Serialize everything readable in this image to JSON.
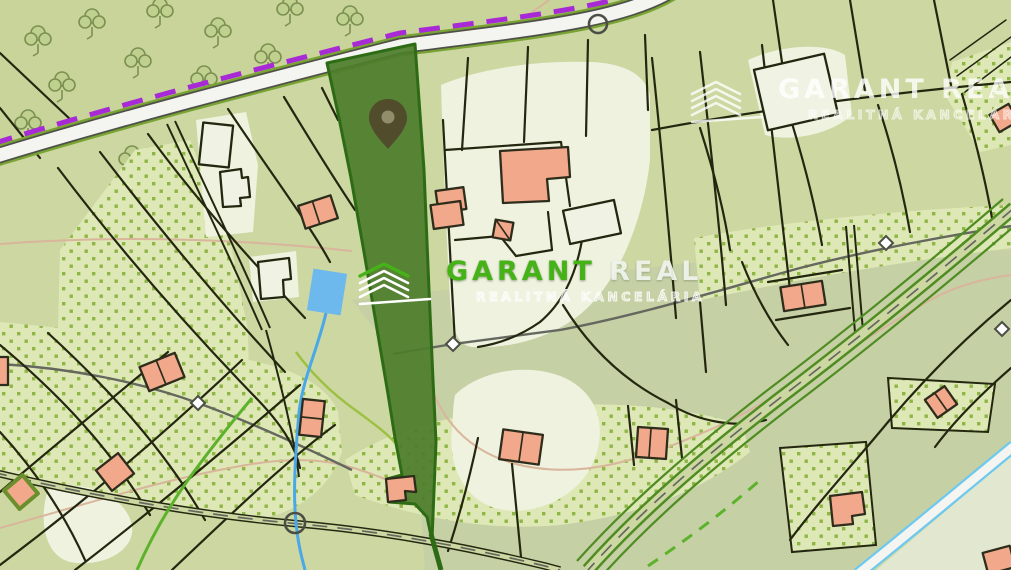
{
  "meta": {
    "view": "cadastral-map",
    "description": "Cadastral map view with a highlighted elongated parcel, location pin and realty watermarks"
  },
  "watermarks": {
    "center": {
      "brand_primary": "GARANT",
      "brand_secondary": "REAL",
      "subtitle": "REALITNÁ KANCELÁRIA"
    },
    "top_right": {
      "brand_primary": "GARANT",
      "brand_secondary": "REAL",
      "subtitle": "REALITNÁ KANCELÁRIA"
    }
  },
  "features": {
    "highlighted_parcel": "selected-parcel",
    "pin": "location-pin",
    "junction_symbol": "circle-junction",
    "waypoint_symbol": "diamond-waypoint",
    "protected_boundary": "purple-dashed-boundary",
    "orchard_fill": "green-dotted-orchard",
    "forest": "deciduous-forest-with-tree-symbols"
  },
  "colors": {
    "base_green": "#ccd7a2",
    "south_tint": "#c6d0a5",
    "forest_green": "#c8d499",
    "pale_plot": "#eef2df",
    "white_plot": "#f0f3e4",
    "corner_pale": "#e2e8d0",
    "dots_bg": "#dee8b6",
    "dot_green": "#8fb544",
    "line_dark": "#23270f",
    "building_salmon": "#f2a88b",
    "building_outline": "#2e2d1c",
    "green_border_building": "#6b8f2c",
    "road_white": "#f4f4f0",
    "road_casing": "#4e5148",
    "road_edge_green": "#79a433",
    "diag_road_green": "#4f8c22",
    "road_cyan": "#6ec9ef",
    "boundary_purple": "#a829d6",
    "path_gray": "#64685f",
    "contour_tan": "#d9b59b",
    "stream_blue": "#4aa8e8",
    "pond_blue": "#6db8ec",
    "bright_path_green": "#5cb32b",
    "yellow_green": "#9cc040",
    "highlight_fill": "#4e7d2b",
    "highlight_border": "#2e6b15",
    "pin_dark": "#504c2c",
    "pin_hole": "#908e6a",
    "brand_green": "#45b318",
    "brand_white": "#eef3ea",
    "symbol_stroke": "#4b4e44",
    "tree_outline": "#7c9052",
    "tree_fill": "#bfd08f"
  }
}
